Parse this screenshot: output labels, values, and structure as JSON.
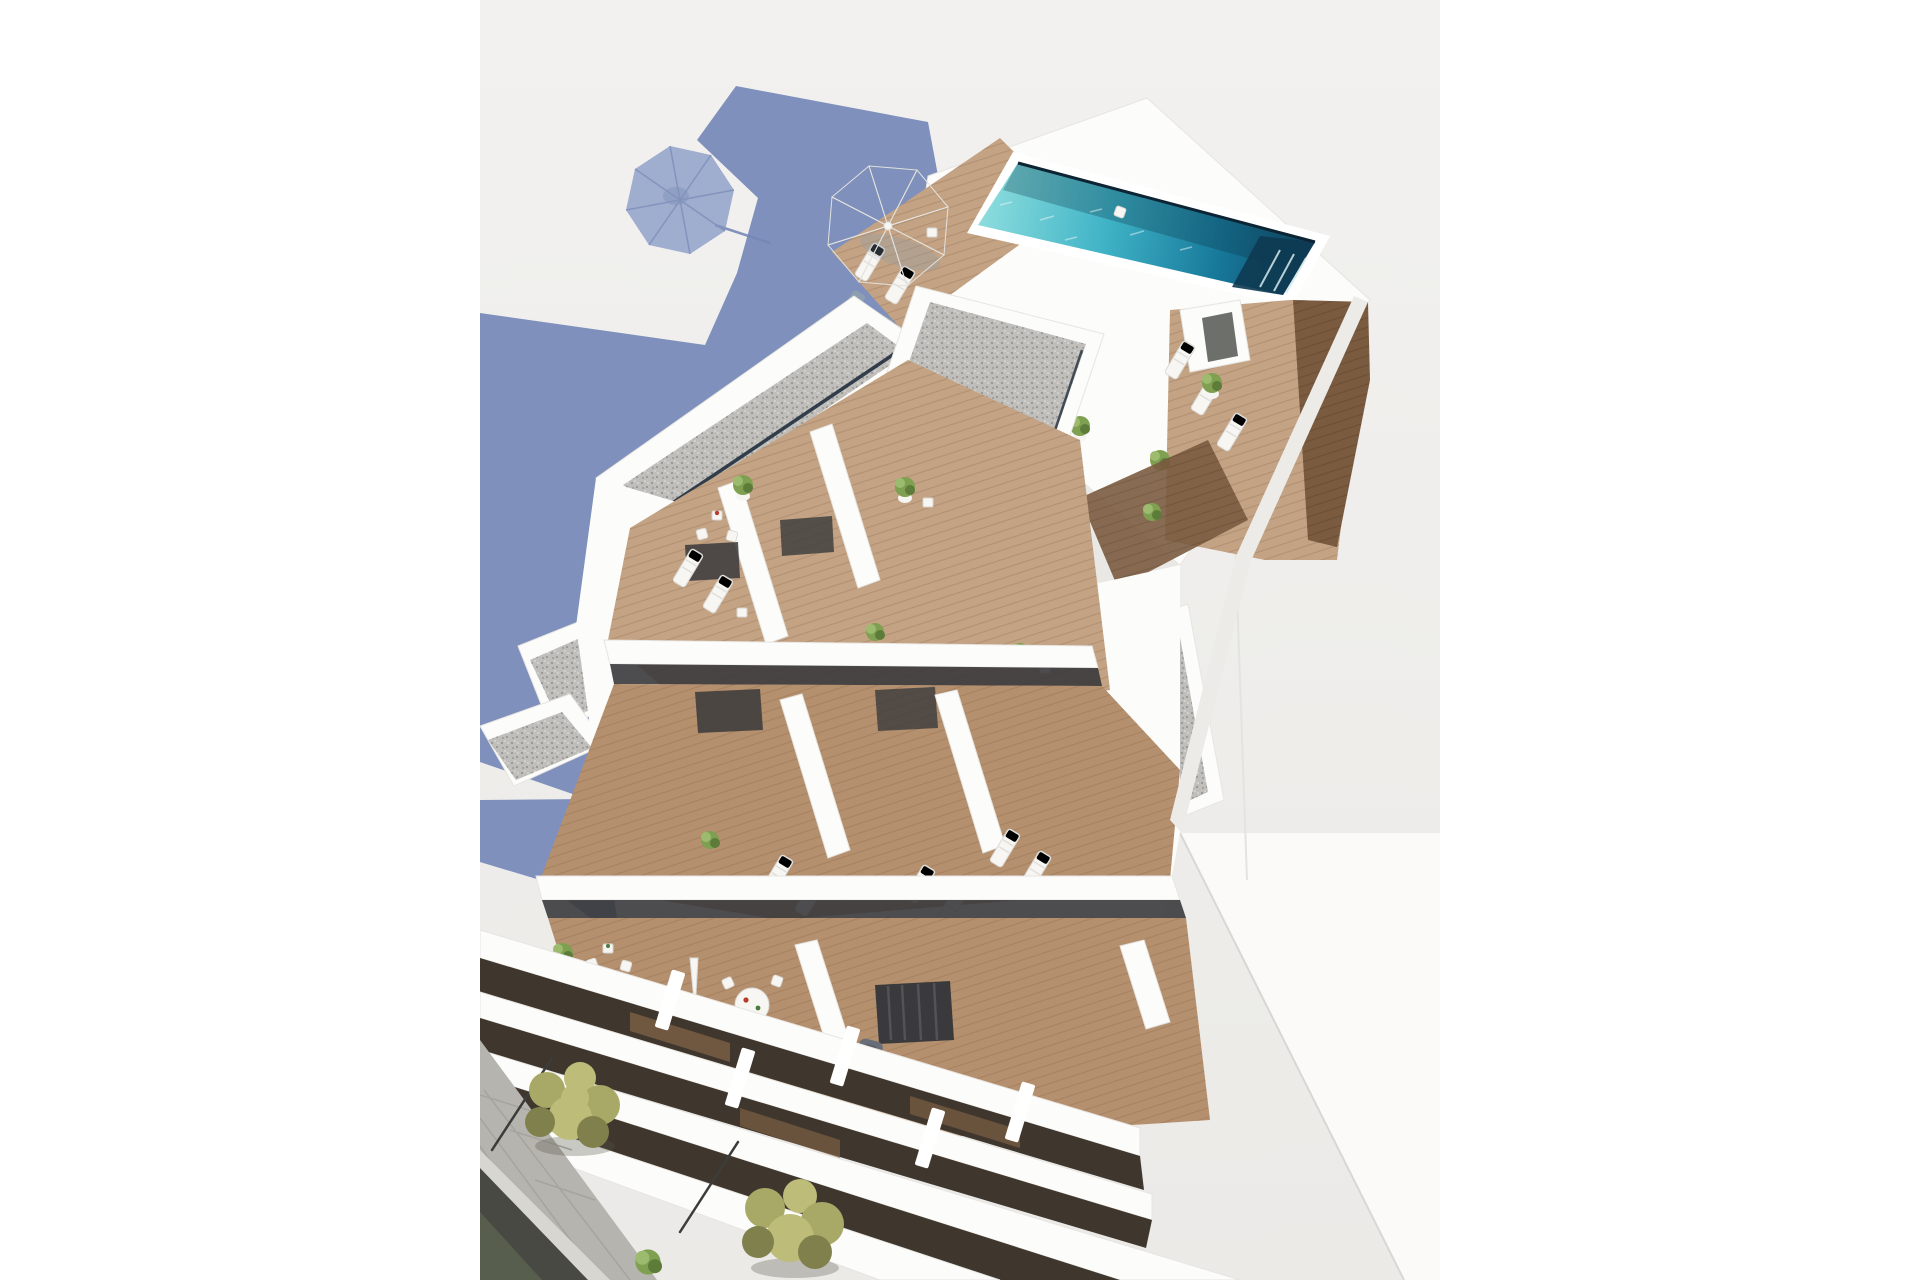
{
  "meta": {
    "kind": "architectural-3d-render",
    "view": "aerial-birdseye",
    "description": "New-build white apartment building seen from above: rooftop terrace with lap pool, parasol and sun loungers; private wood-deck terraces with plants and bistro sets; stepped balcony facade; street with pavement and trees; long blue building shadow cast on ground at upper left."
  },
  "scene": {
    "ground": {
      "label": "lit ground plane"
    },
    "shadow": {
      "label": "building shadow with parasol shadow",
      "parasol_spokes": 8
    },
    "rooftop": {
      "pool": {
        "label": "turquoise lap pool",
        "shape": "elongated parallelogram"
      },
      "parasol": {
        "label": "white octagonal parasol",
        "panels": 8
      },
      "sun_loungers_slate": 3,
      "sun_loungers_white_top": 7,
      "potted_plants": 4
    },
    "roof_blocks": {
      "gravel_roofs": 5,
      "skylight_gap_lines": true,
      "elevator_doors": 2
    },
    "terraces": {
      "rows": 3,
      "bistro_sets": 3,
      "white_loungers_pairs": 4,
      "round_dining_table": {
        "chairs": 4,
        "decor": [
          "red plate",
          "green plate"
        ]
      },
      "armchairs_gray": 2,
      "potted_plants": 7,
      "closed_parasol": 1
    },
    "facade": {
      "white_slab_bands": 4,
      "dark_balcony_recesses": 3,
      "piers": 5
    },
    "street": {
      "sidewalk": "stone pavers",
      "road": "asphalt",
      "trees": 2,
      "lamp_posts": 2
    },
    "neighbor": {
      "label": "adjacent white building wall"
    }
  },
  "colors": {
    "ground": "#f2f1ef",
    "ground_low": "#ebeae7",
    "shadow_main": "#7e90bb",
    "shadow_umbrella": "#97a6cb",
    "shadow_spoke": "#7688b6",
    "wall_lit": "#fcfcfa",
    "wall_bright": "#ffffff",
    "wall_shade": "#e9e8e4",
    "wall_dark": "#d7d5d1",
    "fascia": "#edebe7",
    "navy": "#22303e",
    "pool_a": "#8edede",
    "pool_b": "#3fb3c6",
    "pool_c": "#17789a",
    "pool_d": "#0f4866",
    "pool_rim": "#0c2433",
    "pool_cap": "#0e3a52",
    "pool_streak": "#d3e9ec",
    "wood_light": "#c3a384",
    "wood_light_line": "#a98868",
    "wood_mid": "#b5906f",
    "wood_mid_line": "#9f7b59",
    "wood_dark": "#7b5b40",
    "wood_dark_line": "#64492f",
    "gravel_base": "#bfbeba",
    "gravel_dark": "#8f8e8a",
    "gravel_light": "#e5e4e0",
    "slate": "#8d9eb0",
    "slate_line": "#75869a",
    "white_furn": "#f7f6f3",
    "furn_shade": "#dcdad5",
    "plant_green": "#7fa051",
    "plant_dark": "#5d7c3a",
    "plant_light": "#9dbb6e",
    "pot_white": "#f6f5f2",
    "sage": "#a5aa9c",
    "sage2": "#8f948a",
    "glass_dark": "#3a3a3c",
    "curtain": "#55555a",
    "recess_dark": "#3f372e",
    "recess_wood": "#7d5f45",
    "balustrade": "#dfe4e6",
    "armchair": "#676e77",
    "armchair_dark": "#575e66",
    "pavement": "#b6b4af",
    "pavement_line": "#a19f9a",
    "curb": "#d8d6d1",
    "asphalt": "#494944",
    "asphalt_green": "#59614f",
    "tree_a": "#a9a967",
    "tree_b": "#bdbd79",
    "tree_c": "#80804d",
    "tree_shadow": "#545445",
    "pole": "#3c3c3a",
    "neighbor": "#fbfaf8",
    "neighbor_edge": "#d9d7d3",
    "accent_red": "#b83b2e",
    "accent_green": "#4c7c3c"
  }
}
